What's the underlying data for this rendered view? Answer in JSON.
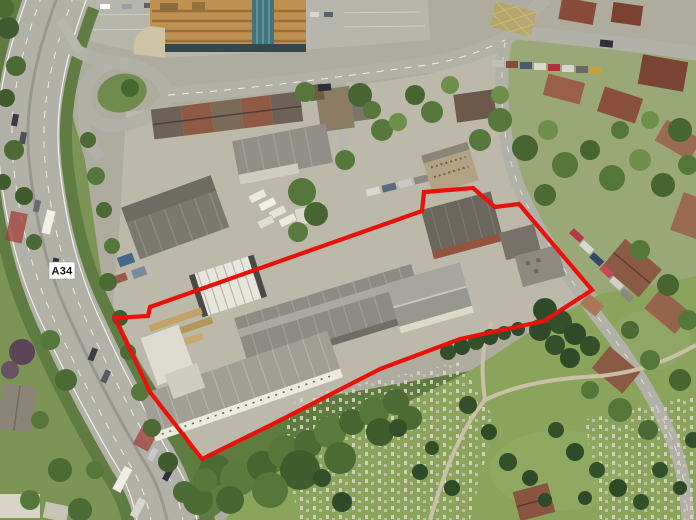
{
  "scene": {
    "type": "oblique-aerial-photograph",
    "route_badge": {
      "label": "A34",
      "bg_color": "#ffffff",
      "text_color": "#111111",
      "x": 49,
      "y": 262,
      "w": 26,
      "h": 17
    },
    "site_boundary": {
      "color": "#e8120a",
      "stroke_width": 4.2,
      "points": [
        [
          115,
          318
        ],
        [
          148,
          316
        ],
        [
          150,
          307
        ],
        [
          422,
          211
        ],
        [
          424,
          192
        ],
        [
          473,
          188
        ],
        [
          495,
          207
        ],
        [
          519,
          204
        ],
        [
          592,
          290
        ],
        [
          544,
          321
        ],
        [
          460,
          339
        ],
        [
          380,
          369
        ],
        [
          273,
          424
        ],
        [
          202,
          459
        ],
        [
          150,
          392
        ]
      ]
    },
    "regions": [
      {
        "name": "a34-dual-carriageway",
        "color": "#b2b1a7"
      },
      {
        "name": "industrial-estate-concrete",
        "color": "#bcb9ab"
      },
      {
        "name": "top-parking-lot",
        "color": "#b7b6ad"
      },
      {
        "name": "office-building",
        "color": "#c09050"
      },
      {
        "name": "cemetery-lawn",
        "color": "#8aa45c"
      },
      {
        "name": "residential-gardens",
        "color": "#9aa878"
      },
      {
        "name": "tree-canopy",
        "color": "#4c6a34"
      },
      {
        "name": "red-bus-lane",
        "color": "#a04038"
      }
    ]
  }
}
